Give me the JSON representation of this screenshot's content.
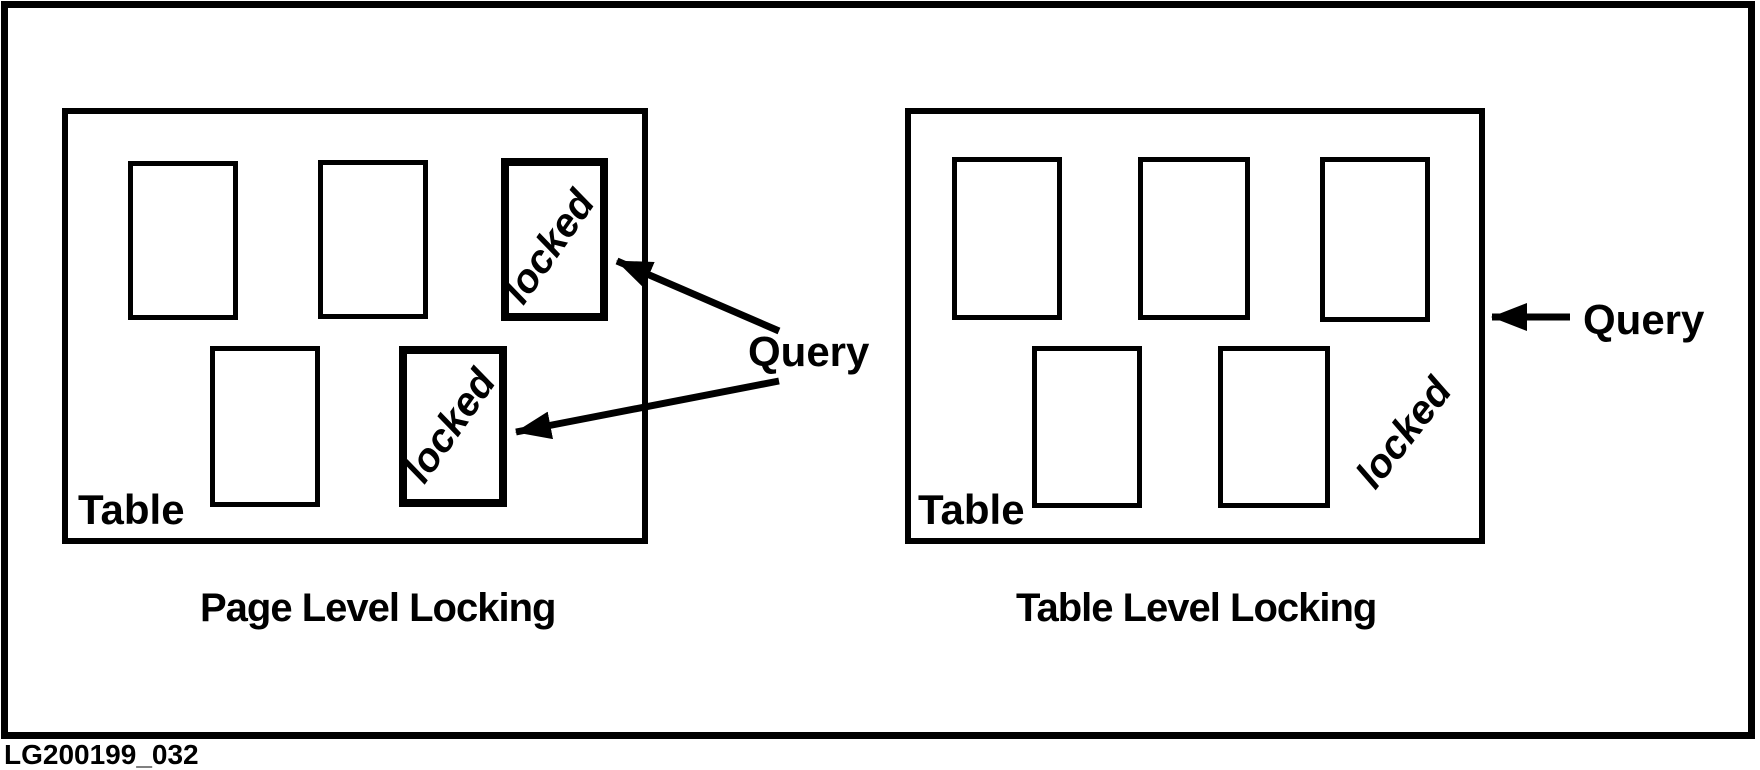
{
  "figure_id": "LG200199_032",
  "left_diagram": {
    "caption": "Page Level Locking",
    "table_label": "Table",
    "query_label": "Query",
    "locked_page_labels": [
      "locked",
      "locked"
    ]
  },
  "right_diagram": {
    "caption": "Table Level Locking",
    "table_label": "Table",
    "query_label": "Query",
    "locked_label": "locked"
  },
  "colors": {
    "ink": "#000000",
    "paper": "#ffffff"
  }
}
